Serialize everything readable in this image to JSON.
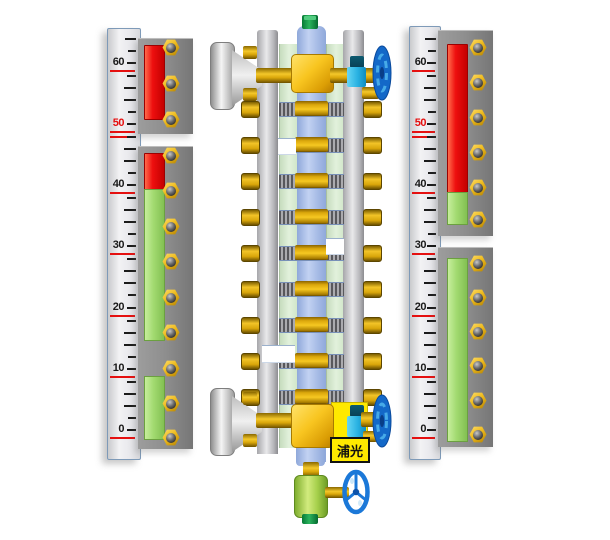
{
  "brand": {
    "label": "浦光"
  },
  "scale": {
    "labels": [
      {
        "text": "60",
        "red": false
      },
      {
        "text": "50",
        "red": true
      },
      {
        "text": "40",
        "red": false
      },
      {
        "text": "30",
        "red": false
      },
      {
        "text": "20",
        "red": false
      },
      {
        "text": "10",
        "red": false
      },
      {
        "text": "0",
        "red": false
      }
    ],
    "label_ys": [
      61,
      122,
      183,
      244,
      306,
      367,
      428
    ]
  },
  "left_ruler": {
    "bars": [
      {
        "color": "red",
        "top": 45,
        "height": 73
      },
      {
        "color": "red",
        "top": 153,
        "height": 36
      },
      {
        "color": "green",
        "top": 189,
        "height": 150
      },
      {
        "color": "green",
        "top": 376,
        "height": 62
      }
    ],
    "nut_rows": [
      47,
      83,
      119,
      155,
      190,
      226,
      261,
      297,
      332,
      368,
      403,
      437
    ]
  },
  "right_ruler": {
    "bars": [
      {
        "color": "red",
        "top": 44,
        "height": 148
      },
      {
        "color": "green",
        "top": 192,
        "height": 31
      },
      {
        "color": "green",
        "top": 258,
        "height": 182
      }
    ],
    "nut_rows": [
      47,
      82,
      117,
      152,
      187,
      219,
      263,
      297,
      331,
      365,
      400,
      434
    ]
  },
  "center": {
    "row_ys": [
      102,
      138,
      174,
      210,
      246,
      282,
      318,
      354,
      390
    ]
  },
  "colors": {
    "bar_red": "#ee1010",
    "bar_green": "#a2da70",
    "panel_gray": "#8e8e8e",
    "scale_red_line": "#e51010",
    "nut_yellow": "#eebb1e",
    "pipe_gold": "#f2c020",
    "tube_blue": "#a7bce6",
    "glass_green": "#d8ecd2",
    "handwheel_blue": "#1368c8",
    "valve_cyan": "#2ab2e2",
    "drain_green": "#a5cf4a",
    "cap_green": "#0a9a44",
    "brand_bg": "#ffe900",
    "brand_text": "#111111"
  }
}
